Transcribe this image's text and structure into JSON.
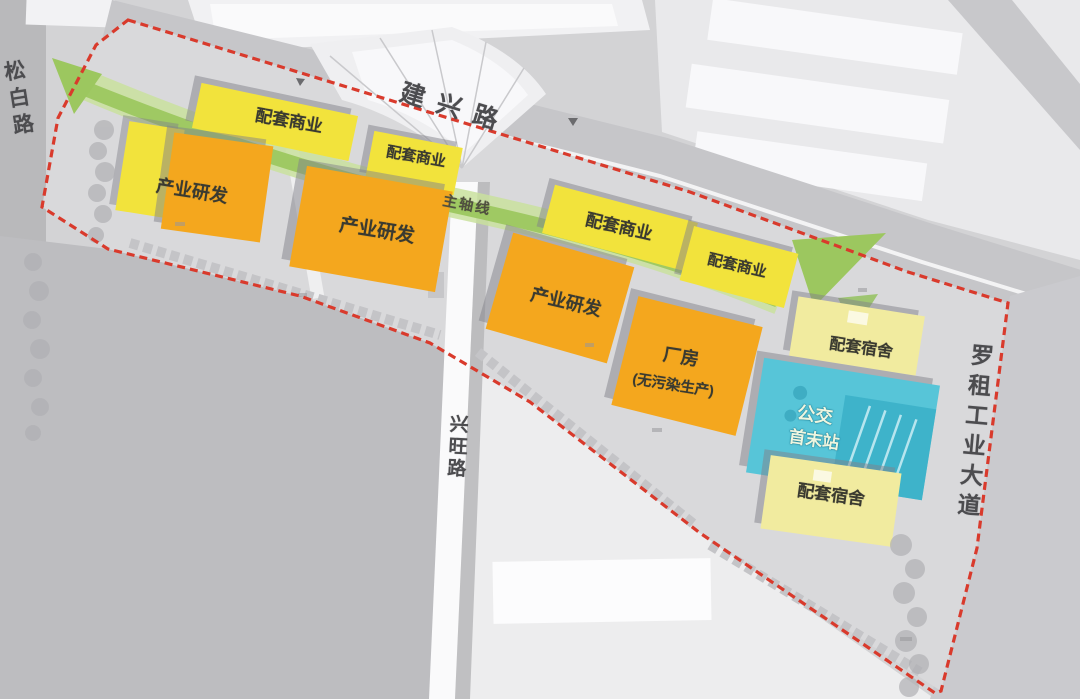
{
  "colors": {
    "commercial_yellow": "#f2e33c",
    "rnd_orange": "#f4a71e",
    "dormitory_pale_yellow": "#f1eb9f",
    "bus_blue": "#57c5d8",
    "bus_blue_dark": "#39afc8",
    "boundary_red": "#d93a2c",
    "axis_green": "#9cc75f",
    "axis_green_light": "#c9e09d",
    "road_gray": "#c7c7ca",
    "text_dark": "#3a3a30"
  },
  "roads": [
    {
      "id": "jianxing",
      "label": "建兴路",
      "orientation": "horizontal"
    },
    {
      "id": "songbai",
      "label": "松白路",
      "orientation": "vertical"
    },
    {
      "id": "xingwang",
      "label": "兴旺路",
      "orientation": "vertical"
    },
    {
      "id": "luozu",
      "label": "罗租工业大道",
      "orientation": "vertical"
    }
  ],
  "axis": {
    "label": "主轴线"
  },
  "buildings": [
    {
      "id": "commercial-1",
      "label": "配套商业",
      "category": "commercial"
    },
    {
      "id": "commercial-2",
      "label": "配套商业",
      "category": "commercial"
    },
    {
      "id": "rnd-1",
      "label": "产业研发",
      "category": "rnd"
    },
    {
      "id": "rnd-2",
      "label": "产业研发",
      "category": "rnd"
    },
    {
      "id": "commercial-3",
      "label": "配套商业",
      "category": "commercial"
    },
    {
      "id": "commercial-4",
      "label": "配套商业",
      "category": "commercial"
    },
    {
      "id": "rnd-3",
      "label": "产业研发",
      "category": "rnd"
    },
    {
      "id": "factory",
      "label": "厂房",
      "sublabel": "(无污染生产)",
      "category": "factory"
    },
    {
      "id": "dorm-1",
      "label": "配套宿舍",
      "category": "dormitory"
    },
    {
      "id": "bus-terminal",
      "label": "公交",
      "sublabel": "首末站",
      "category": "bus"
    },
    {
      "id": "dorm-2",
      "label": "配套宿舍",
      "category": "dormitory"
    }
  ],
  "boundary": {
    "style": "red-dashed-site-limit"
  }
}
